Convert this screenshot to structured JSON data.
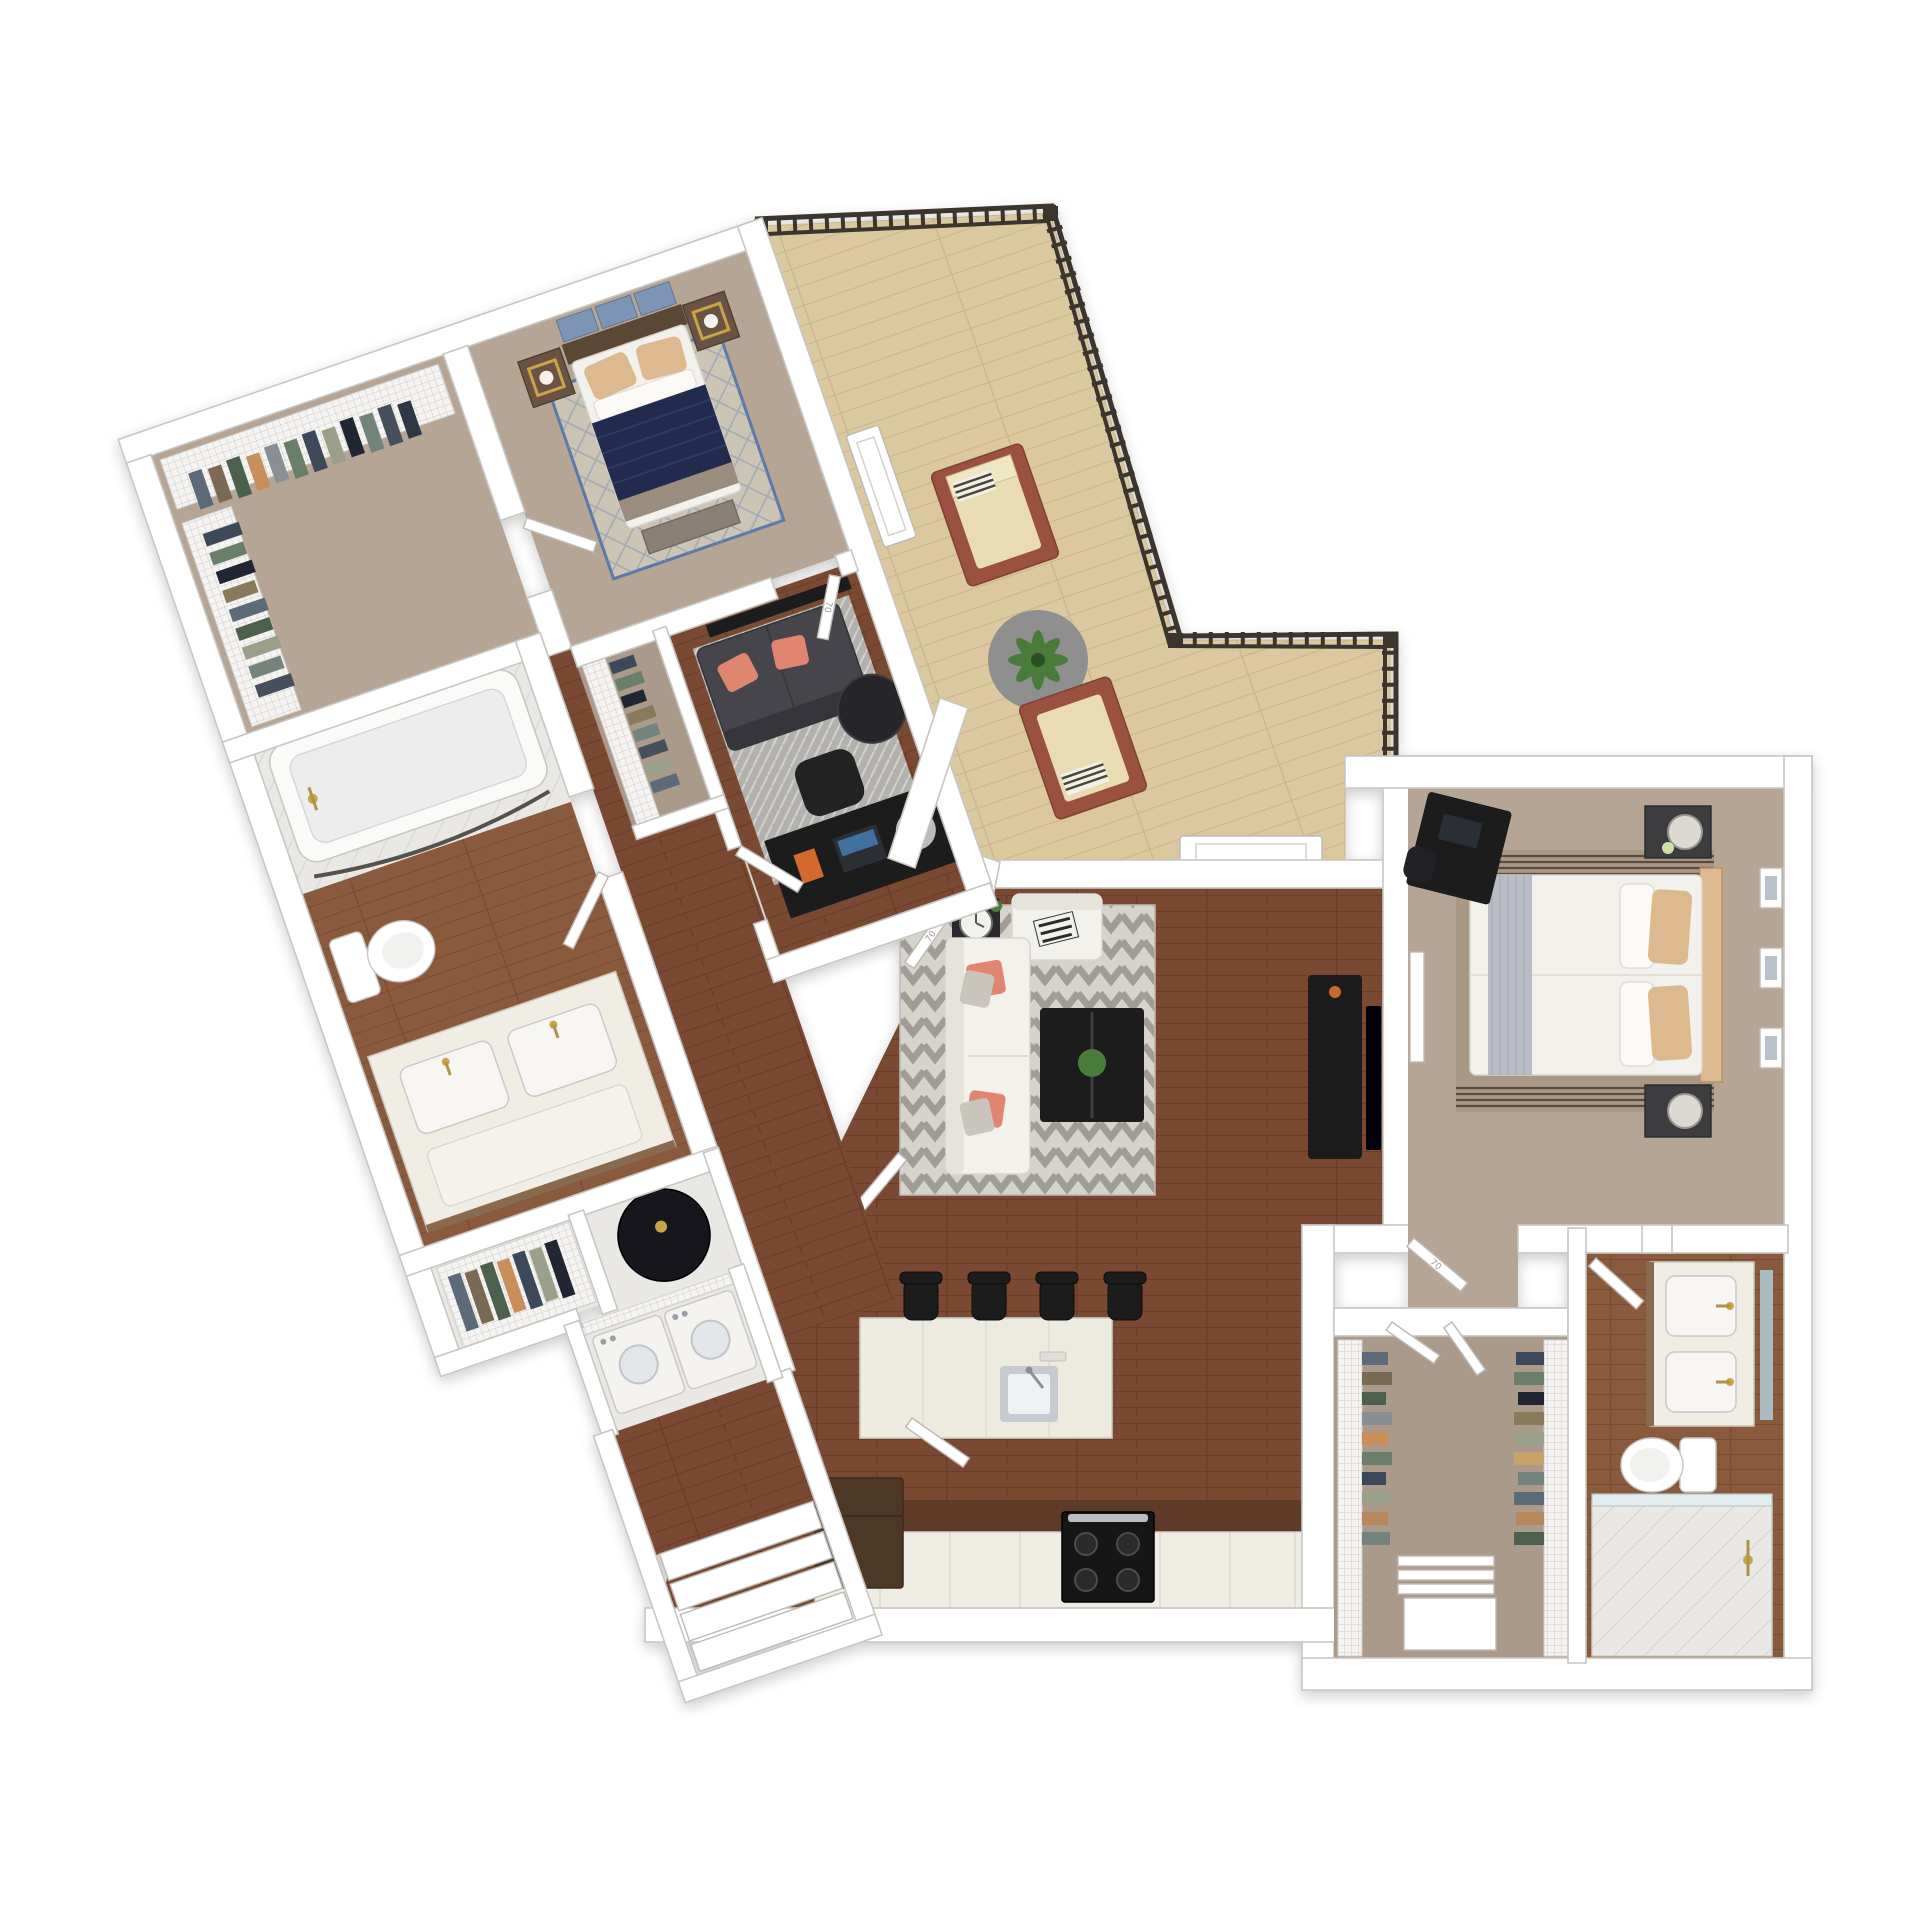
{
  "meta": {
    "kind": "3d-top-down-floor-plan-render",
    "background": "#ffffff",
    "units_note": "two-bedroom apartment with balcony, angled left wing"
  },
  "palette": {
    "bg": "#ffffff",
    "wall": "#ffffff",
    "wall_edge": "#c8c6c2",
    "wood_dark": "#7a4a32",
    "wood_dark_line": "#693e28",
    "wood_med": "#8a5a3c",
    "wood_med_line": "#794c30",
    "balcony_wood": "#dcc89f",
    "balcony_line": "#cab58a",
    "carpet": "#b6a595",
    "carpet2": "#ab9a8a",
    "tile": "#e9e8e4",
    "railing": "#3a342d",
    "navy": "#232c4e",
    "white_fabric": "#f2f1ec",
    "sofa_dark": "#45454b",
    "coral": "#e08570",
    "tan_pillow": "#dcb98e",
    "black_furn": "#1a1a1d",
    "gray_rug": "#b3b1ad",
    "island": "#edeadf",
    "counter_top": "#5d3b28",
    "cabinet": "#f0ede5",
    "fridge": "#4e3727",
    "steel": "#c7cbd0",
    "gold": "#c9a44a",
    "plant": "#4a7c3a",
    "headboard": "#5c4736",
    "wood_furn": "#6b5342",
    "blue_art": "#7d95b5",
    "cushion": "#e9dcb4",
    "chair_wood": "#9a5140"
  },
  "doors": {
    "label": "70"
  },
  "rooms": [
    {
      "id": "walk-in-closet-2",
      "floor": "carpet",
      "features": [
        "wire-shelving",
        "hanging-clothes"
      ]
    },
    {
      "id": "bedroom-2",
      "floor": "carpet",
      "features": [
        "queen-bed-navy",
        "2-nightstands",
        "2-lamps",
        "wall-art",
        "diamond-rug",
        "bench"
      ]
    },
    {
      "id": "bathroom-2",
      "floor": "wood",
      "features": [
        "bathtub",
        "curved-shower-rod",
        "toilet",
        "double-vanity"
      ]
    },
    {
      "id": "den-office",
      "floor": "wood",
      "features": [
        "loveseat",
        "coral-pillows",
        "area-rug",
        "round-side-table",
        "wall-tv",
        "desk",
        "desk-chair",
        "reach-in-closet"
      ]
    },
    {
      "id": "hallway",
      "floor": "wood",
      "features": [
        "linen-closet",
        "water-heater-closet",
        "laundry-closet"
      ]
    },
    {
      "id": "laundry-closet",
      "floor": "tile",
      "features": [
        "washer",
        "dryer",
        "wire-shelf"
      ]
    },
    {
      "id": "entry",
      "floor": "wood",
      "features": [
        "steps"
      ]
    },
    {
      "id": "balcony",
      "floor": "light-wood-deck",
      "features": [
        "metal-railing",
        "lounge-chairs",
        "round-rug",
        "potted-plant",
        "sliding-door-panels"
      ]
    },
    {
      "id": "living-room",
      "floor": "wood",
      "features": [
        "sectional-sofa",
        "chevron-rug",
        "coffee-table",
        "plant-centerpiece",
        "side-table",
        "media-console",
        "tv"
      ]
    },
    {
      "id": "kitchen",
      "floor": "wood",
      "features": [
        "island-with-sink",
        "bar-stools",
        "refrigerator",
        "range-cooktop",
        "base-cabinets"
      ]
    },
    {
      "id": "master-bedroom",
      "floor": "carpet",
      "features": [
        "king-bed",
        "tan-pillows",
        "striped-rug",
        "2-nightstand-lamps",
        "desk",
        "wall-frames",
        "wall-tv-frame"
      ]
    },
    {
      "id": "master-walk-in-closet",
      "floor": "carpet",
      "features": [
        "wire-shelving-both-sides",
        "shoe-rack",
        "storage-bin"
      ]
    },
    {
      "id": "master-bathroom",
      "floor": "wood",
      "features": [
        "double-vanity",
        "mirror",
        "toilet",
        "walk-in-shower"
      ]
    }
  ],
  "counts": {
    "bar_stools": 4,
    "balcony_lounge_chairs": 2,
    "bedrooms": 2,
    "bathrooms": 2,
    "wall_frames_master": 3,
    "bed_art_panels": 3,
    "entry_steps": 4
  }
}
